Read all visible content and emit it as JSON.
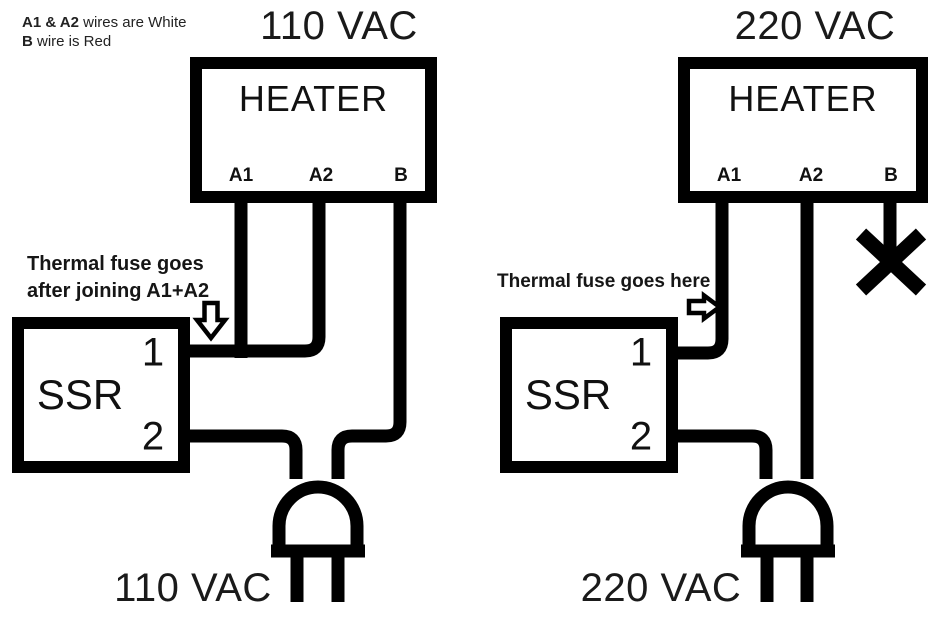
{
  "note": {
    "line1_bold": "A1 & A2",
    "line1_rest": " wires are White",
    "line2_bold": "B",
    "line2_rest": " wire is Red"
  },
  "left_diagram": {
    "title": "110 VAC",
    "heater_label": "HEATER",
    "terminals": [
      "A1",
      "A2",
      "B"
    ],
    "ssr_label": "SSR",
    "ssr_terminals": [
      "1",
      "2"
    ],
    "annotation_line1": "Thermal fuse goes",
    "annotation_line2": "after joining A1+A2",
    "source_label": "110 VAC"
  },
  "right_diagram": {
    "title": "220 VAC",
    "heater_label": "HEATER",
    "terminals": [
      "A1",
      "A2",
      "B"
    ],
    "ssr_label": "SSR",
    "ssr_terminals": [
      "1",
      "2"
    ],
    "annotation": "Thermal fuse goes here",
    "source_label": "220 VAC"
  },
  "colors": {
    "line": "#000000",
    "text": "#1a1a1a",
    "background": "#ffffff"
  }
}
